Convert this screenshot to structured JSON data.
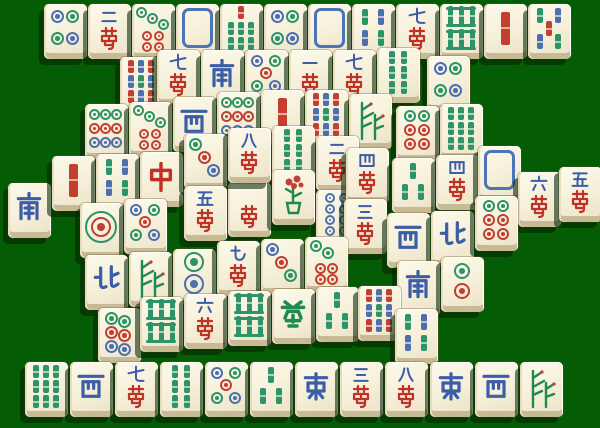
{
  "board": {
    "width": 600,
    "height": 428,
    "background_color": "#045c04",
    "tile_face_color": "#f6f0da",
    "tile_side_color": "#c9ba96",
    "shadow_color": "rgba(3,36,3,0.58)",
    "layout_name": "turtle"
  },
  "palette": {
    "circle_green": "#2c9468",
    "circle_blue": "#4e6fae",
    "circle_red": "#c23f32",
    "char_blue": "#3c5da8",
    "char_red": "#c03226",
    "char_green": "#1f8a4d",
    "dragon_frame_blue": "#4d74b5"
  },
  "tiles": [
    {
      "x": 44,
      "y": 4,
      "face": "c4",
      "name": "four-circles",
      "text": ""
    },
    {
      "x": 88,
      "y": 4,
      "face": "wan2",
      "name": "two-characters",
      "text": "二萬"
    },
    {
      "x": 132,
      "y": 4,
      "face": "c7",
      "name": "seven-circles",
      "text": ""
    },
    {
      "x": 176,
      "y": 4,
      "face": "dw",
      "name": "white-dragon",
      "text": ""
    },
    {
      "x": 220,
      "y": 4,
      "face": "b7",
      "name": "seven-bamboo",
      "text": ""
    },
    {
      "x": 264,
      "y": 4,
      "face": "c4",
      "name": "four-circles",
      "text": ""
    },
    {
      "x": 308,
      "y": 4,
      "face": "dw",
      "name": "white-dragon",
      "text": ""
    },
    {
      "x": 352,
      "y": 4,
      "face": "b4",
      "name": "four-bamboo",
      "text": ""
    },
    {
      "x": 396,
      "y": 4,
      "face": "wan7",
      "name": "seven-characters",
      "text": "七萬"
    },
    {
      "x": 440,
      "y": 4,
      "face": "b8",
      "name": "eight-bamboo",
      "text": ""
    },
    {
      "x": 484,
      "y": 4,
      "face": "b1",
      "name": "one-bamboo",
      "text": ""
    },
    {
      "x": 528,
      "y": 4,
      "face": "b5",
      "name": "five-bamboo",
      "text": ""
    },
    {
      "x": 120,
      "y": 57,
      "face": "b9m",
      "name": "nine-bamboo",
      "text": ""
    },
    {
      "x": 427,
      "y": 56,
      "face": "c4",
      "name": "four-circles",
      "text": ""
    },
    {
      "x": 157,
      "y": 50,
      "face": "wan7",
      "name": "seven-characters",
      "text": "七萬"
    },
    {
      "x": 201,
      "y": 50,
      "face": "ws",
      "name": "south-wind",
      "text": "南"
    },
    {
      "x": 245,
      "y": 50,
      "face": "c5",
      "name": "five-circles",
      "text": ""
    },
    {
      "x": 289,
      "y": 50,
      "face": "wan1",
      "name": "one-character",
      "text": "一萬"
    },
    {
      "x": 333,
      "y": 50,
      "face": "wan7",
      "name": "seven-characters",
      "text": "七萬"
    },
    {
      "x": 377,
      "y": 48,
      "face": "b6",
      "name": "six-bamboo",
      "text": ""
    },
    {
      "x": 85,
      "y": 104,
      "face": "c9",
      "name": "nine-circles",
      "text": ""
    },
    {
      "x": 129,
      "y": 102,
      "face": "c7",
      "name": "seven-circles",
      "text": ""
    },
    {
      "x": 173,
      "y": 97,
      "face": "ww",
      "name": "west-wind",
      "text": "西"
    },
    {
      "x": 217,
      "y": 92,
      "face": "c9",
      "name": "nine-circles",
      "text": ""
    },
    {
      "x": 261,
      "y": 90,
      "face": "b1",
      "name": "one-bamboo",
      "text": ""
    },
    {
      "x": 305,
      "y": 90,
      "face": "b9m",
      "name": "nine-bamboo",
      "text": ""
    },
    {
      "x": 349,
      "y": 94,
      "face": "fbam",
      "name": "flower-bamboo",
      "text": ""
    },
    {
      "x": 396,
      "y": 106,
      "face": "c6",
      "name": "six-circles",
      "text": ""
    },
    {
      "x": 440,
      "y": 104,
      "face": "b9",
      "name": "nine-bamboo",
      "text": ""
    },
    {
      "x": 8,
      "y": 183,
      "face": "ws",
      "name": "south-wind",
      "text": "南"
    },
    {
      "x": 52,
      "y": 156,
      "face": "b1",
      "name": "one-bamboo",
      "text": ""
    },
    {
      "x": 96,
      "y": 154,
      "face": "b4",
      "name": "four-bamboo",
      "text": ""
    },
    {
      "x": 140,
      "y": 152,
      "face": "dr",
      "name": "red-dragon",
      "text": "中"
    },
    {
      "x": 184,
      "y": 134,
      "face": "c3a",
      "name": "three-circles",
      "text": ""
    },
    {
      "x": 272,
      "y": 126,
      "face": "b6",
      "name": "six-bamboo",
      "text": ""
    },
    {
      "x": 228,
      "y": 182,
      "face": "wanh",
      "name": "character-tile-partly-hidden",
      "text": "萬"
    },
    {
      "x": 316,
      "y": 136,
      "face": "wan2",
      "name": "two-characters",
      "text": "二萬"
    },
    {
      "x": 316,
      "y": 190,
      "face": "c8",
      "name": "eight-circles",
      "text": ""
    },
    {
      "x": 346,
      "y": 148,
      "face": "wan4",
      "name": "four-characters",
      "text": "四萬"
    },
    {
      "x": 344,
      "y": 199,
      "face": "wan3",
      "name": "three-characters",
      "text": "三萬"
    },
    {
      "x": 272,
      "y": 170,
      "face": "fplum",
      "name": "flower-plum",
      "text": ""
    },
    {
      "x": 184,
      "y": 186,
      "face": "wan5",
      "name": "five-characters",
      "text": "五萬"
    },
    {
      "x": 228,
      "y": 128,
      "face": "wan8",
      "name": "eight-characters-top-tile",
      "text": "八萬"
    },
    {
      "x": 392,
      "y": 158,
      "face": "b3",
      "name": "three-bamboo",
      "text": ""
    },
    {
      "x": 436,
      "y": 155,
      "face": "wan4",
      "name": "four-characters",
      "text": "四萬"
    },
    {
      "x": 478,
      "y": 146,
      "face": "dw",
      "name": "white-dragon",
      "text": ""
    },
    {
      "x": 518,
      "y": 172,
      "face": "wan6",
      "name": "six-characters",
      "text": "六萬"
    },
    {
      "x": 559,
      "y": 167,
      "face": "wan5",
      "name": "five-characters",
      "text": "五萬"
    },
    {
      "x": 387,
      "y": 213,
      "face": "ww",
      "name": "west-wind",
      "text": "西"
    },
    {
      "x": 431,
      "y": 211,
      "face": "wn",
      "name": "north-wind",
      "text": "北"
    },
    {
      "x": 475,
      "y": 196,
      "face": "c6",
      "name": "six-circles",
      "text": ""
    },
    {
      "x": 80,
      "y": 203,
      "face": "c1",
      "name": "one-circle",
      "text": ""
    },
    {
      "x": 124,
      "y": 199,
      "face": "c5",
      "name": "five-circles",
      "text": ""
    },
    {
      "x": 85,
      "y": 255,
      "face": "wn",
      "name": "north-wind",
      "text": "北"
    },
    {
      "x": 129,
      "y": 252,
      "face": "fbam",
      "name": "flower-bamboo",
      "text": ""
    },
    {
      "x": 173,
      "y": 249,
      "face": "c2",
      "name": "two-circles",
      "text": ""
    },
    {
      "x": 217,
      "y": 241,
      "face": "wan9",
      "name": "nine-characters",
      "text": "九萬"
    },
    {
      "x": 261,
      "y": 239,
      "face": "c3b",
      "name": "three-circles",
      "text": ""
    },
    {
      "x": 305,
      "y": 237,
      "face": "c6b",
      "name": "six-circles",
      "text": ""
    },
    {
      "x": 397,
      "y": 261,
      "face": "ws",
      "name": "south-wind",
      "text": "南"
    },
    {
      "x": 441,
      "y": 257,
      "face": "c2b",
      "name": "two-circles",
      "text": ""
    },
    {
      "x": 98,
      "y": 308,
      "face": "chain6",
      "name": "six-circles-chain",
      "text": ""
    },
    {
      "x": 140,
      "y": 297,
      "face": "b8",
      "name": "eight-bamboo",
      "text": ""
    },
    {
      "x": 184,
      "y": 294,
      "face": "wan6",
      "name": "six-characters",
      "text": "六萬"
    },
    {
      "x": 228,
      "y": 291,
      "face": "b8",
      "name": "eight-bamboo",
      "text": ""
    },
    {
      "x": 272,
      "y": 289,
      "face": "dg",
      "name": "green-dragon",
      "text": "發"
    },
    {
      "x": 316,
      "y": 287,
      "face": "b3",
      "name": "three-bamboo",
      "text": ""
    },
    {
      "x": 358,
      "y": 286,
      "face": "b9m",
      "name": "nine-bamboo",
      "text": ""
    },
    {
      "x": 395,
      "y": 309,
      "face": "b4",
      "name": "four-bamboo",
      "text": ""
    },
    {
      "x": 25,
      "y": 362,
      "face": "b9",
      "name": "nine-bamboo",
      "text": ""
    },
    {
      "x": 70,
      "y": 362,
      "face": "ww",
      "name": "west-wind",
      "text": "西"
    },
    {
      "x": 115,
      "y": 362,
      "face": "wan7",
      "name": "seven-characters",
      "text": "七萬"
    },
    {
      "x": 160,
      "y": 362,
      "face": "b6",
      "name": "six-bamboo",
      "text": ""
    },
    {
      "x": 205,
      "y": 362,
      "face": "c5",
      "name": "five-circles",
      "text": ""
    },
    {
      "x": 250,
      "y": 362,
      "face": "b3",
      "name": "three-bamboo",
      "text": ""
    },
    {
      "x": 295,
      "y": 362,
      "face": "we",
      "name": "east-wind",
      "text": "東"
    },
    {
      "x": 340,
      "y": 362,
      "face": "wan3",
      "name": "three-characters",
      "text": "三萬"
    },
    {
      "x": 385,
      "y": 362,
      "face": "wan8",
      "name": "eight-characters",
      "text": "八萬"
    },
    {
      "x": 430,
      "y": 362,
      "face": "we",
      "name": "east-wind",
      "text": "東"
    },
    {
      "x": 475,
      "y": 362,
      "face": "ww",
      "name": "west-wind",
      "text": "西"
    },
    {
      "x": 520,
      "y": 362,
      "face": "fbam",
      "name": "flower-bamboo",
      "text": ""
    }
  ]
}
